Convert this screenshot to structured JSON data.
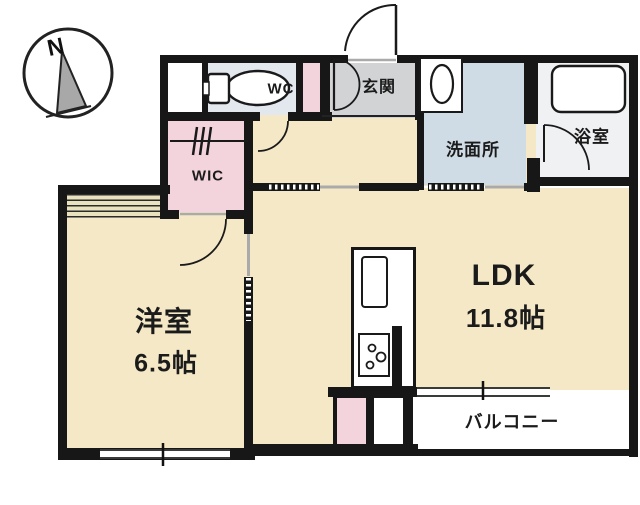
{
  "compass": {
    "label": "N"
  },
  "rooms": {
    "ldk": {
      "label": "LDK",
      "size": "11.8帖"
    },
    "western_room": {
      "label": "洋室",
      "size": "6.5帖"
    },
    "entrance": {
      "label": "玄関"
    },
    "wc": {
      "label": "WC"
    },
    "washroom": {
      "label": "洗面所"
    },
    "bathroom": {
      "label": "浴室"
    },
    "walk_in_closet": {
      "label": "WIC"
    },
    "balcony": {
      "label": "バルコニー"
    }
  },
  "icons": {
    "compass": "compass-north-icon",
    "toilet": "toilet-icon",
    "washbasin": "washbasin-icon",
    "bathtub": "bathtub-icon",
    "kitchen_sink": "kitchen-sink-icon",
    "stove": "stove-burners-icon",
    "hanger": "closet-hanger-icon",
    "doors": "door-swing-arc-icon",
    "sliding_doors": "sliding-door-icon",
    "windows": "window-double-line-icon"
  },
  "colors": {
    "floor_cream": "#f5e8c6",
    "closet_pink": "#f3d4dd",
    "entrance_gray": "#d2d3d5",
    "washroom_blue": "#cfdbe5",
    "wc_blue": "#e3e8ef",
    "bathroom_white": "#f0f1f3",
    "balcony_white": "#ffffff",
    "wall_black": "#171717"
  }
}
